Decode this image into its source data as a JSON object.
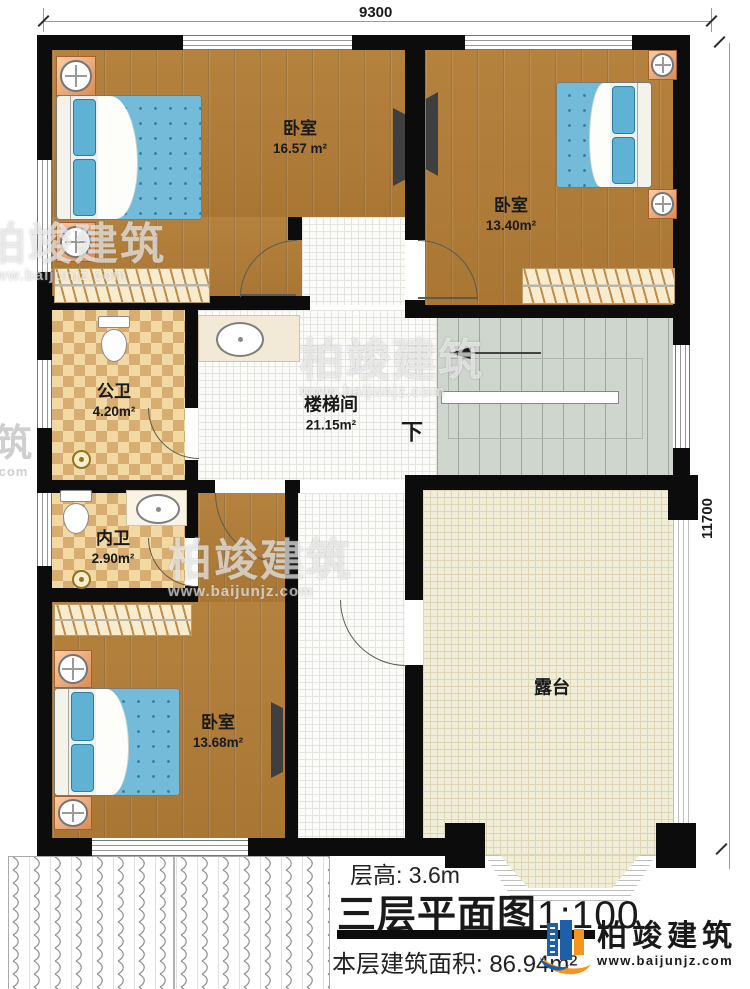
{
  "plan": {
    "dim_top": "9300",
    "dim_right": "11700",
    "down_label": "下"
  },
  "rooms": [
    {
      "label": "卧室",
      "area": "16.57 m²"
    },
    {
      "label": "卧室",
      "area": "13.40m²"
    },
    {
      "label": "公卫",
      "area": "4.20m²"
    },
    {
      "label": "楼梯间",
      "area": "21.15m²"
    },
    {
      "label": "内卫",
      "area": "2.90m²"
    },
    {
      "label": "卧室",
      "area": "13.68m²"
    },
    {
      "label": "露台",
      "area": ""
    }
  ],
  "footer": {
    "floor_height": "层高: 3.6m",
    "title": "三层平面图",
    "scale": "1:100",
    "area_line": "本层建筑面积: 86.94m²"
  },
  "brand": {
    "name": "柏竣建筑",
    "url": "www.baijunjz.com"
  },
  "watermarks": [
    {
      "name": "柏竣建筑",
      "url": "www.baijunjz.com"
    },
    {
      "name": "柏竣建筑",
      "url": "www.baijunjz.com"
    },
    {
      "name": "柏竣建筑",
      "url": "www.baijunjz.com"
    },
    {
      "name": "筑",
      "url": ".com"
    }
  ],
  "colors": {
    "wall": "#0c0c0c",
    "wood_floor": "#b5823e",
    "bed_blue": "#74bad9",
    "checker_dark": "#d8ad72",
    "checker_light": "#f2d9a4",
    "stairs_gray": "#cfd6cd",
    "terrace_cream": "#f0edd9",
    "brand_blue": "#1e5fa8",
    "brand_orange": "#f7941d"
  }
}
